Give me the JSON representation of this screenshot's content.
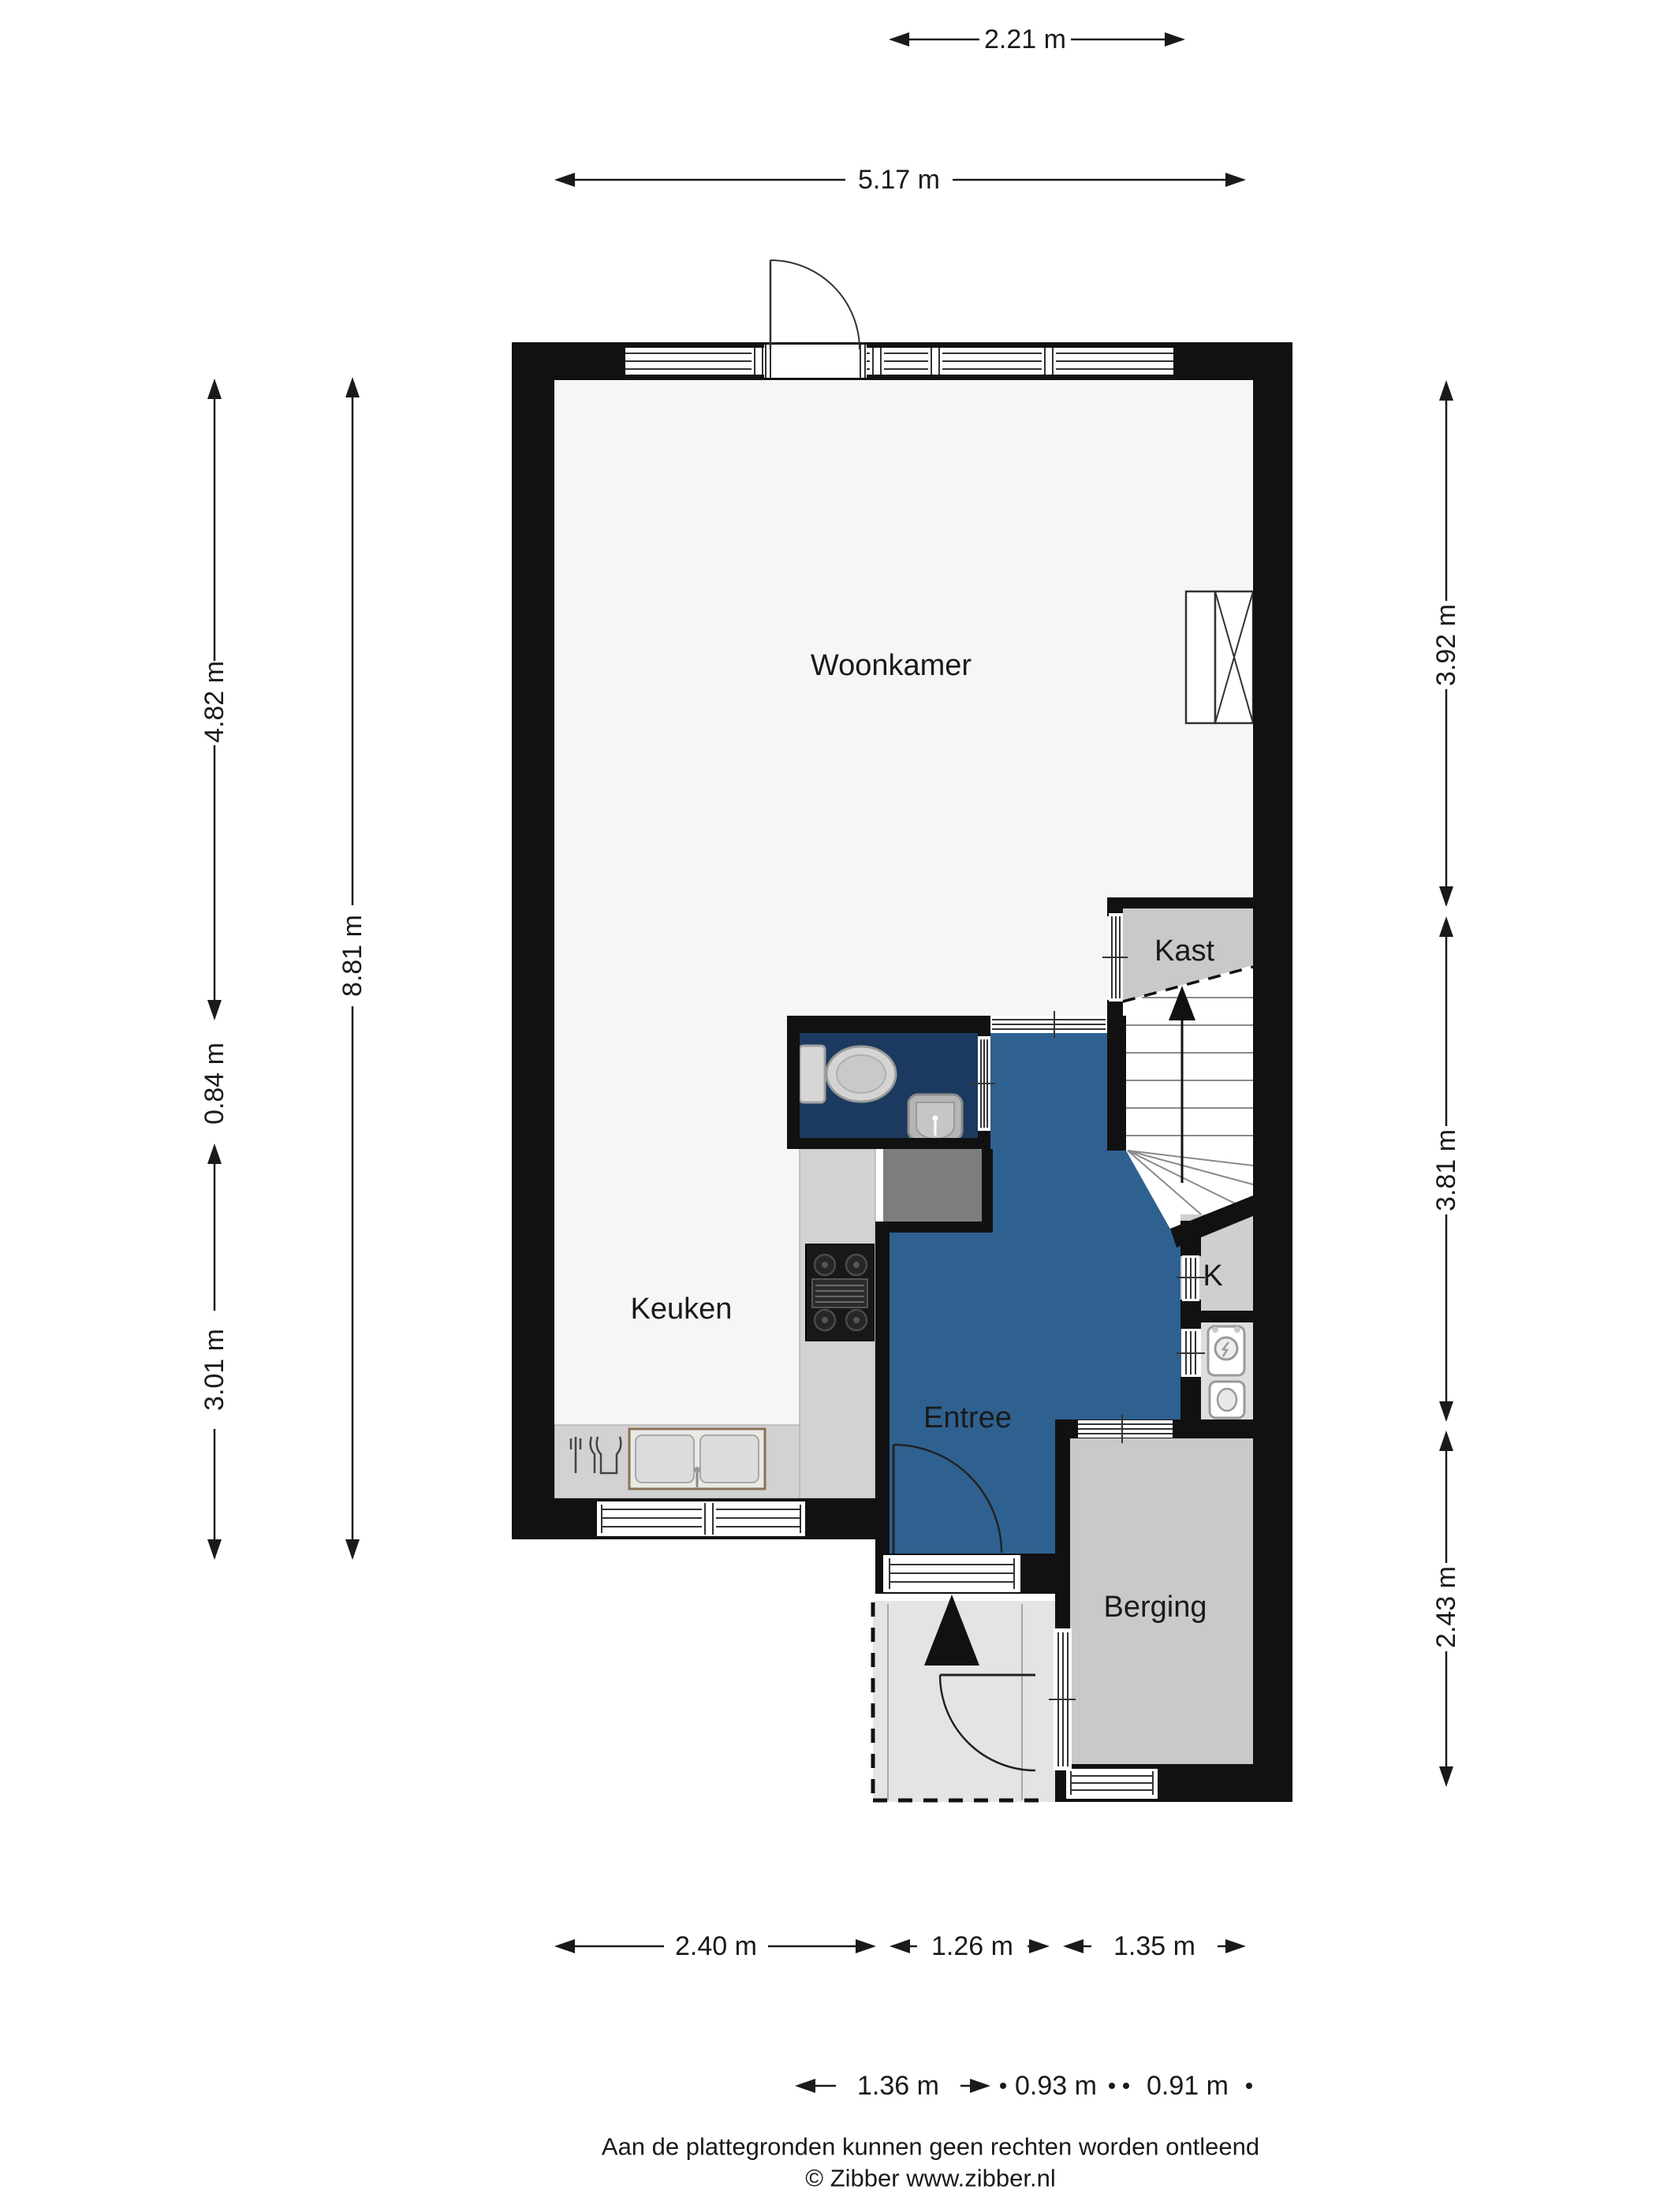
{
  "page": {
    "type": "floor-plan"
  },
  "rooms": {
    "woonkamer": {
      "label": "Woonkamer"
    },
    "keuken": {
      "label": "Keuken"
    },
    "entree": {
      "label": "Entree"
    },
    "kast": {
      "label": "Kast"
    },
    "k": {
      "label": "K"
    },
    "berging": {
      "label": "Berging"
    }
  },
  "dimensions": {
    "top": [
      {
        "label": "2.21 m"
      },
      {
        "label": "5.17 m"
      }
    ],
    "left_outer": [
      {
        "label": "8.81 m"
      }
    ],
    "left_inner": [
      {
        "label": "4.82 m"
      },
      {
        "label": "0.84 m"
      },
      {
        "label": "3.01 m"
      }
    ],
    "right": [
      {
        "label": "3.92 m"
      },
      {
        "label": "3.81 m"
      },
      {
        "label": "2.43 m"
      }
    ],
    "bottom_outer": [
      {
        "label": "2.40 m"
      },
      {
        "label": "1.26 m"
      },
      {
        "label": "1.35 m"
      }
    ],
    "bottom_inner": [
      {
        "label": "1.36 m"
      },
      {
        "label": "0.93 m"
      },
      {
        "label": "0.91 m"
      }
    ]
  },
  "footer": {
    "disclaimer": "Aan de plattegronden kunnen geen rechten worden ontleend",
    "copyright": "© Zibber www.zibber.nl"
  },
  "colors": {
    "wall": "#111111",
    "room_floor": "#f6f6f6",
    "wc_floor": "#1c3a5f",
    "entree_floor": "#2f6190",
    "closet_floor": "#c9c9c9",
    "k_floor": "#cfcfcf",
    "boiler_floor": "#dedede",
    "berging_floor": "#c9c9c9",
    "porch_floor": "#e4e4e4",
    "counter": "#d2d2d2",
    "cabinet_dark": "#7d7d7d"
  },
  "icons": {
    "toilet": "toilet-icon",
    "wc_sink": "sink-icon",
    "stove": "stove-icon",
    "kitchen_sink": "kitchen-sink-icon",
    "cutlery": "cutlery-icon",
    "duct": "duct-shaft-icon",
    "boiler": "boiler-icon",
    "water_heater": "water-heater-icon",
    "stairs_arrow": "stairs-up-arrow-icon",
    "entrance_arrow": "entrance-arrow-icon"
  }
}
